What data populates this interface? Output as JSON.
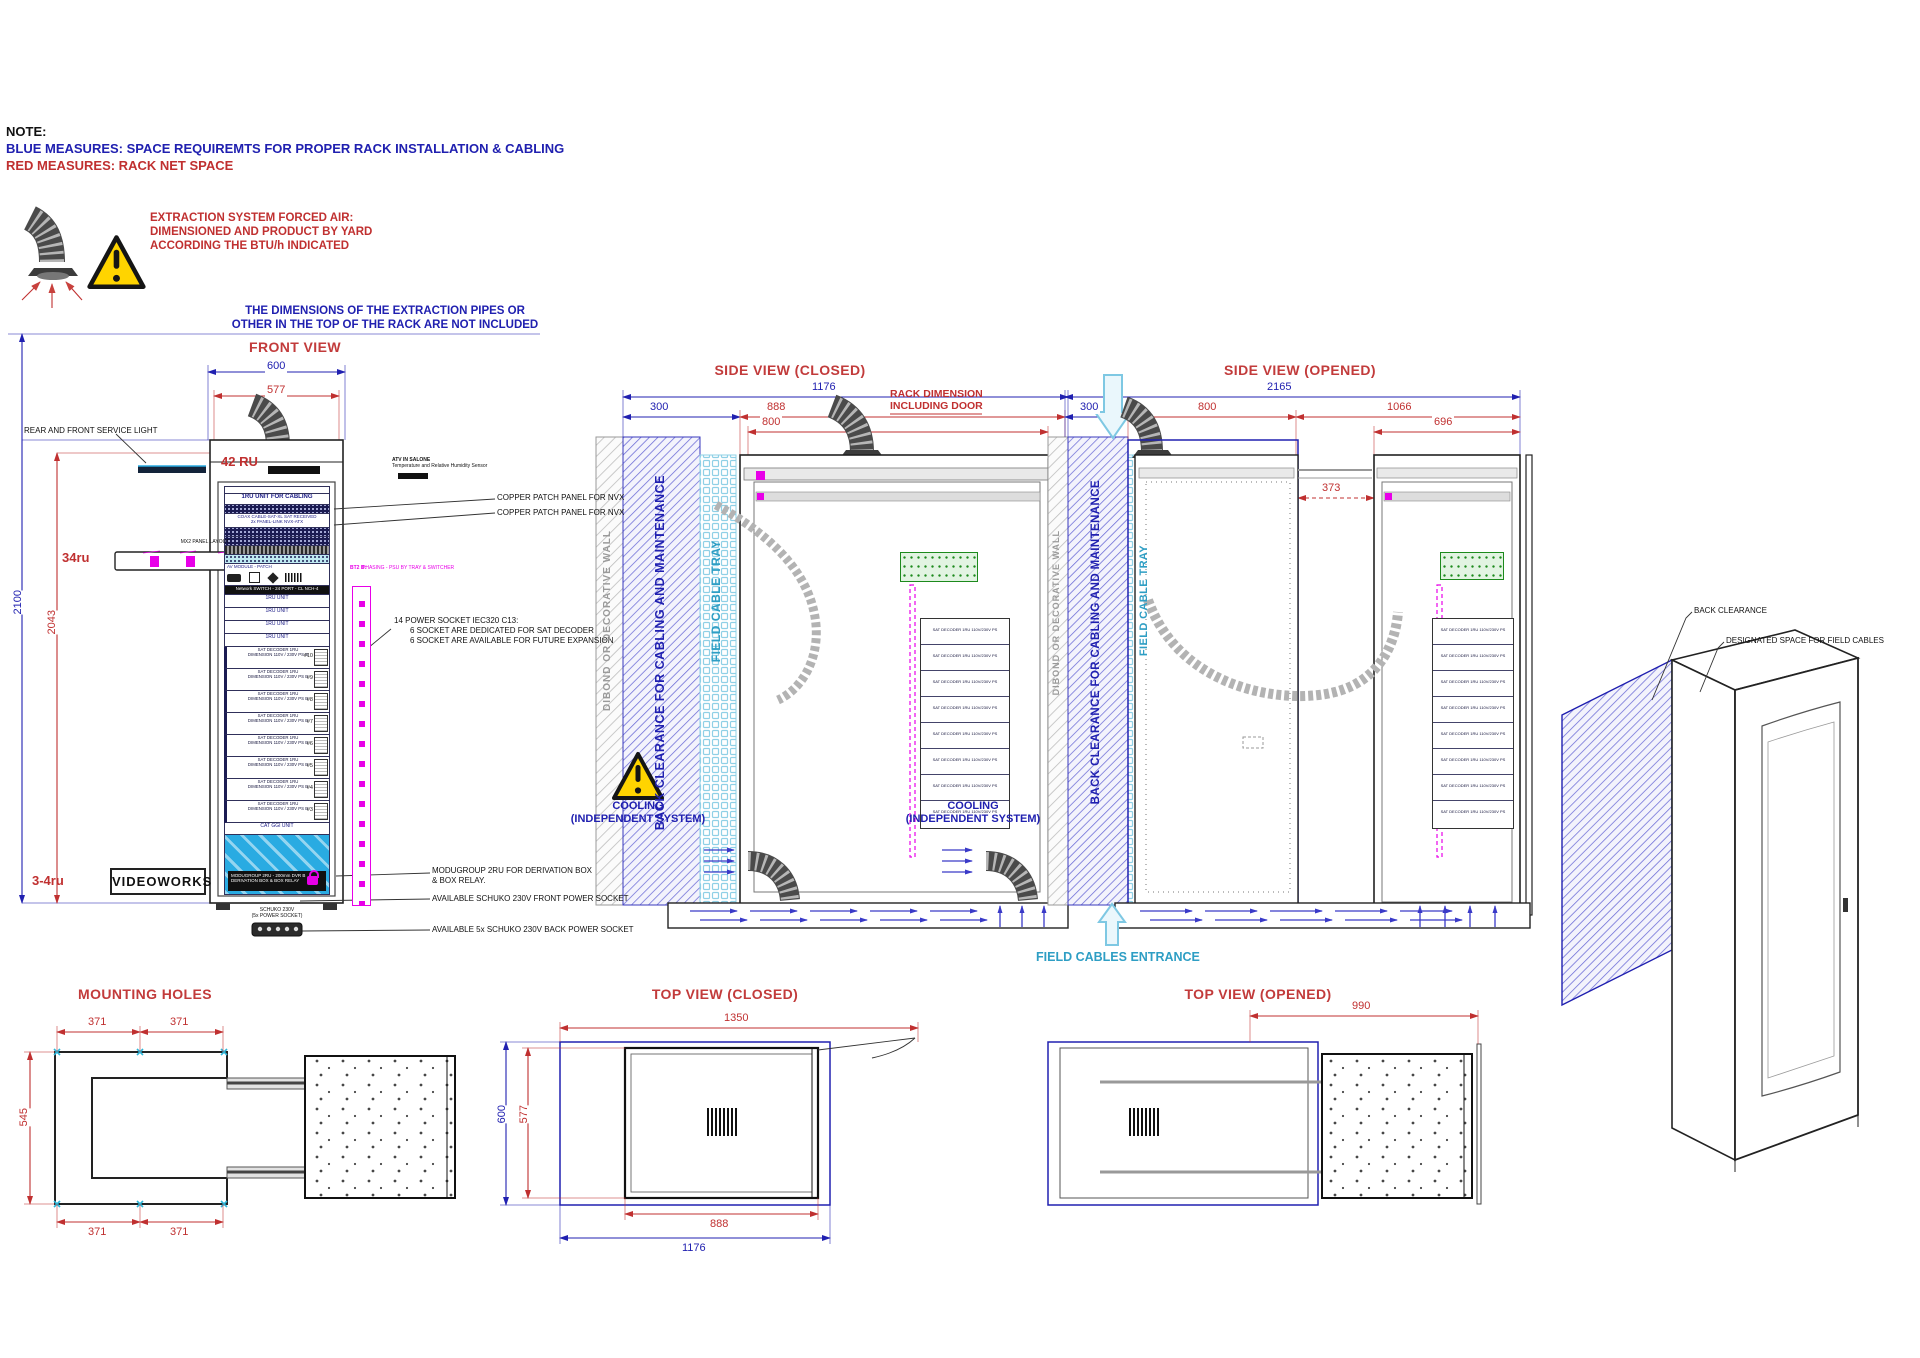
{
  "note": {
    "title": "NOTE:",
    "blue_line": "BLUE MEASURES: SPACE REQUIREMTS FOR PROPER RACK INSTALLATION & CABLING",
    "red_line": "RED MEASURES: RACK NET SPACE"
  },
  "extraction": {
    "line1": "EXTRACTION SYSTEM FORCED AIR:",
    "line2": "DIMENSIONED AND PRODUCT  BY YARD",
    "line3": "ACCORDING THE BTU/h INDICATED"
  },
  "pipes_note": {
    "line1": "THE DIMENSIONS OF THE EXTRACTION PIPES OR",
    "line2": "OTHER IN THE TOP OF THE RACK ARE NOT INCLUDED"
  },
  "front_view": {
    "title": "FRONT VIEW",
    "dim_width_install": "600",
    "dim_width_net": "577",
    "dim_height_install": "2100",
    "dim_height_net": "2043",
    "ru42": "42 RU",
    "ru34": "34ru",
    "panel34_label": "MX2 PANEL LAYOUT",
    "ru34_bottom": "3-4ru",
    "service_light": "REAR AND FRONT SERVICE LIGHT",
    "sensor_line1": "ATV IN SALONE",
    "sensor_line2": "Temperature and Relative Humidity Sensor",
    "logo": "VIDEOWORKS",
    "units": {
      "cabling": "1RU UNIT FOR CABLING",
      "coax1": "COAX CABLE-SAT-XL SAT RECEIVED",
      "coax2": "2x PANEL-LINK NVX-ATX",
      "av": "AV MODULE - PATCH",
      "switch": "Network SWITCH - 24 PORT - CL NCH-4",
      "spare": "1RU UNIT",
      "decoder1": "SAT DECODER 1RU",
      "decoder2": "DIMENSION 110V / 230V PS B",
      "cat": "CAT GGI UNIT",
      "modubox1": "MODUGROUP 2RU - 200mm DVR B",
      "modubox2": "DERIVATION BOX & BOX RELAY"
    },
    "decoder_tags": [
      "#10",
      "#9",
      "#8",
      "#7",
      "#6",
      "#5",
      "#4",
      "#3"
    ],
    "pdu_line1": "BT2 B:",
    "pdu_line2": "PHASING - PSU BY TRAY & SWITCHER",
    "callouts": {
      "copper1": "COPPER PATCH PANEL FOR NVX",
      "copper2": "COPPER PATCH PANEL FOR NVX",
      "power1": "14 POWER SOCKET IEC320 C13:",
      "power2": "6 SOCKET ARE DEDICATED FOR SAT DECODER",
      "power3": "6 SOCKET ARE AVAILABLE FOR FUTURE EXPANSION",
      "modugroup1": "MODUGROUP 2RU FOR DERIVATION BOX",
      "modugroup2": "& BOX RELAY.",
      "front_socket": "AVAILABLE SCHUKO 230V FRONT POWER SOCKET",
      "back_socket": "AVAILABLE 5x SCHUKO 230V BACK POWER SOCKET"
    },
    "strip_line1": "SCHUKO 230V",
    "strip_line2": "(5x POWER SOCKET)"
  },
  "side_closed": {
    "title": "SIDE VIEW (CLOSED)",
    "dim_1176": "1176",
    "dim_300": "300",
    "dim_888": "888",
    "dim_800": "800",
    "rack_dim_note1": "RACK DIMENSION",
    "rack_dim_note2": "INCLUDING DOOR",
    "wall_label": "DIBOND OR DECORATIVE WALL",
    "clearance_label": "BACK CLEARANCE FOR CABLING AND MAINTENANCE",
    "tray_label": "FIELD CABLE TRAY",
    "cooling1": "COOLING",
    "cooling2": "(INDEPENDENT SYSTEM)",
    "decoder_row": "SAT DECODER 1RU 110V/230V PS"
  },
  "side_opened": {
    "title": "SIDE VIEW (OPENED)",
    "dim_2165": "2165",
    "dim_300": "300",
    "dim_800": "800",
    "dim_1066": "1066",
    "dim_696": "696",
    "dim_373": "373",
    "wall_label": "DIBOND OR DECORATIVE WALL",
    "clearance_label": "BACK CLEARANCE FOR CABLING AND MAINTENANCE",
    "tray_label": "FIELD CABLE TRAY",
    "cooling1": "COOLING",
    "cooling2": "(INDEPENDENT SYSTEM)",
    "field_entrance": "FIELD CABLES ENTRANCE"
  },
  "mounting": {
    "title": "MOUNTING HOLES",
    "dim_371a": "371",
    "dim_371b": "371",
    "dim_371c": "371",
    "dim_371d": "371",
    "dim_545": "545"
  },
  "top_closed": {
    "title": "TOP VIEW (CLOSED)",
    "dim_1350": "1350",
    "dim_600": "600",
    "dim_577": "577",
    "dim_888": "888",
    "dim_1176": "1176"
  },
  "top_opened": {
    "title": "TOP VIEW (OPENED)",
    "dim_990": "990"
  },
  "iso": {
    "back_clearance": "BACK CLEARANCE",
    "designated": "DESIGNATED SPACE FOR FIELD CABLES"
  },
  "colors": {
    "measure_blue": "#2020b0",
    "measure_red": "#c03030",
    "magenta": "#e800e8",
    "teal": "#2e9ec4",
    "panel_navy": "#1b1b52",
    "cyan_panel": "#29abe2"
  }
}
